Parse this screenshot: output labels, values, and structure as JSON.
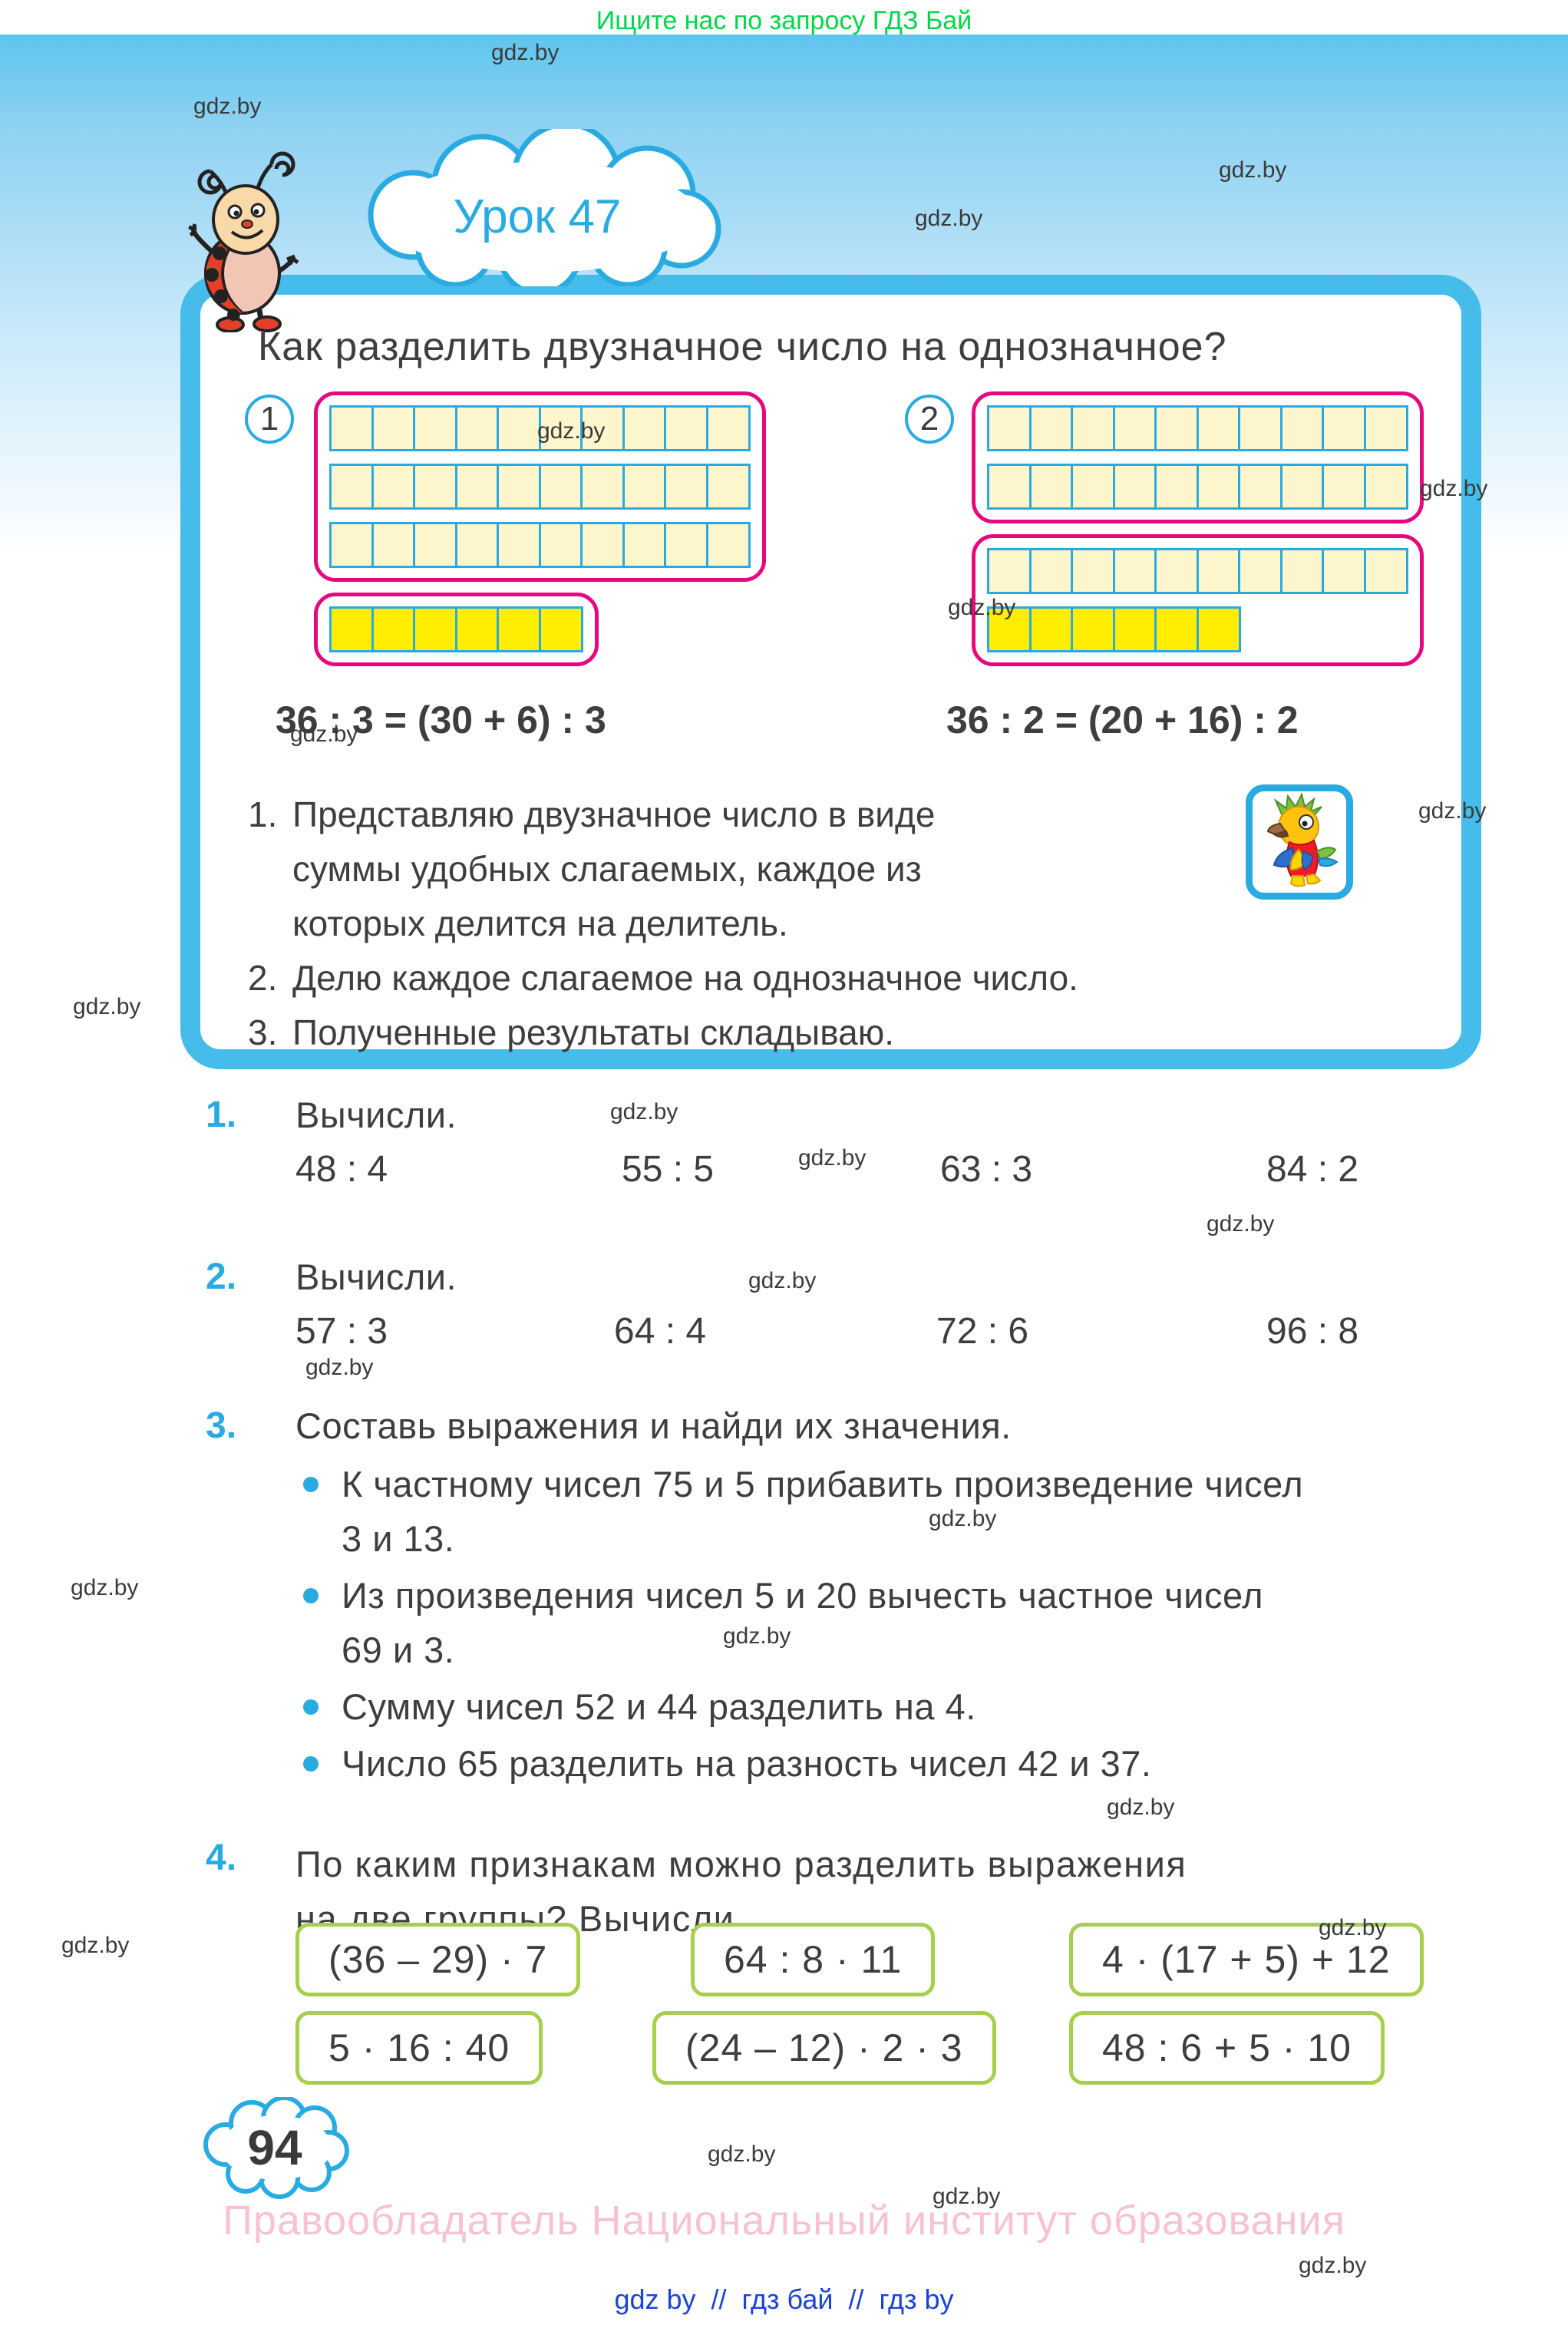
{
  "page": {
    "header_notice": "Ищите нас по запросу ГДЗ Бай",
    "watermark": "gdz.by",
    "lesson_badge": "Урок 47",
    "page_number": "94",
    "copyright": "Правообладатель Национальный институт образования",
    "footer_links": [
      "gdz by",
      "гдз бай",
      "гдз by"
    ],
    "footer_separator": "//"
  },
  "colors": {
    "accent_blue": "#29abe2",
    "box_border_blue": "#45bce9",
    "pink_outline": "#e5097f",
    "pale_cell": "#fdf6cd",
    "yellow_cell": "#ffee00",
    "green_box_border": "#a6cf4c",
    "text": "#3e3e3d",
    "promo_green": "#00d64a",
    "link_blue": "#1c43d8",
    "copyright_pink": "#f7c2d4"
  },
  "theory": {
    "title": "Как разделить двузначное число на однозначное?",
    "diagram1": {
      "label": "1",
      "block_a_rows": [
        [
          "pale",
          10
        ],
        [
          "pale",
          10
        ],
        [
          "pale",
          10
        ]
      ],
      "block_b_rows": [
        [
          "yellow",
          6
        ]
      ],
      "equation": "36 : 3 = (30 + 6) : 3"
    },
    "diagram2": {
      "label": "2",
      "block_a_rows": [
        [
          "pale",
          10
        ],
        [
          "pale",
          10
        ]
      ],
      "block_b_rows": [
        [
          "pale",
          10
        ],
        [
          "yellow",
          6
        ]
      ],
      "equation": "36 : 2 = (20 + 16) : 2"
    },
    "steps": [
      {
        "num": "1.",
        "text": "Представляю двузначное число в виде суммы удобных слагаемых, каждое из которых делится на делитель."
      },
      {
        "num": "2.",
        "text": "Делю каждое слагаемое на однозначное число."
      },
      {
        "num": "3.",
        "text": "Полученные результаты складываю."
      }
    ]
  },
  "exercises": [
    {
      "num": "1.",
      "title": "Вычисли.",
      "items": [
        "48 : 4",
        "55 : 5",
        "63 : 3",
        "84 : 2"
      ]
    },
    {
      "num": "2.",
      "title": "Вычисли.",
      "items": [
        "57 : 3",
        "64 : 4",
        "72 : 6",
        "96 : 8"
      ]
    },
    {
      "num": "3.",
      "title": "Составь выражения и найди их значения.",
      "bullets": [
        "К частному чисел 75 и 5 прибавить произведение чисел 3 и 13.",
        "Из произведения чисел 5 и 20 вычесть частное чисел 69 и 3.",
        "Сумму чисел 52 и 44 разделить на 4.",
        "Число 65 разделить на разность чисел 42 и 37."
      ]
    },
    {
      "num": "4.",
      "title": "По каким признакам можно разделить выражения на две группы? Вычисли.",
      "boxes_row1": [
        "(36 – 29) · 7",
        "64 : 8 · 11",
        "4 · (17 + 5) + 12"
      ],
      "boxes_row2": [
        "5 · 16 : 40",
        "(24 – 12) · 2 · 3",
        "48 : 6 + 5 · 10"
      ]
    }
  ]
}
